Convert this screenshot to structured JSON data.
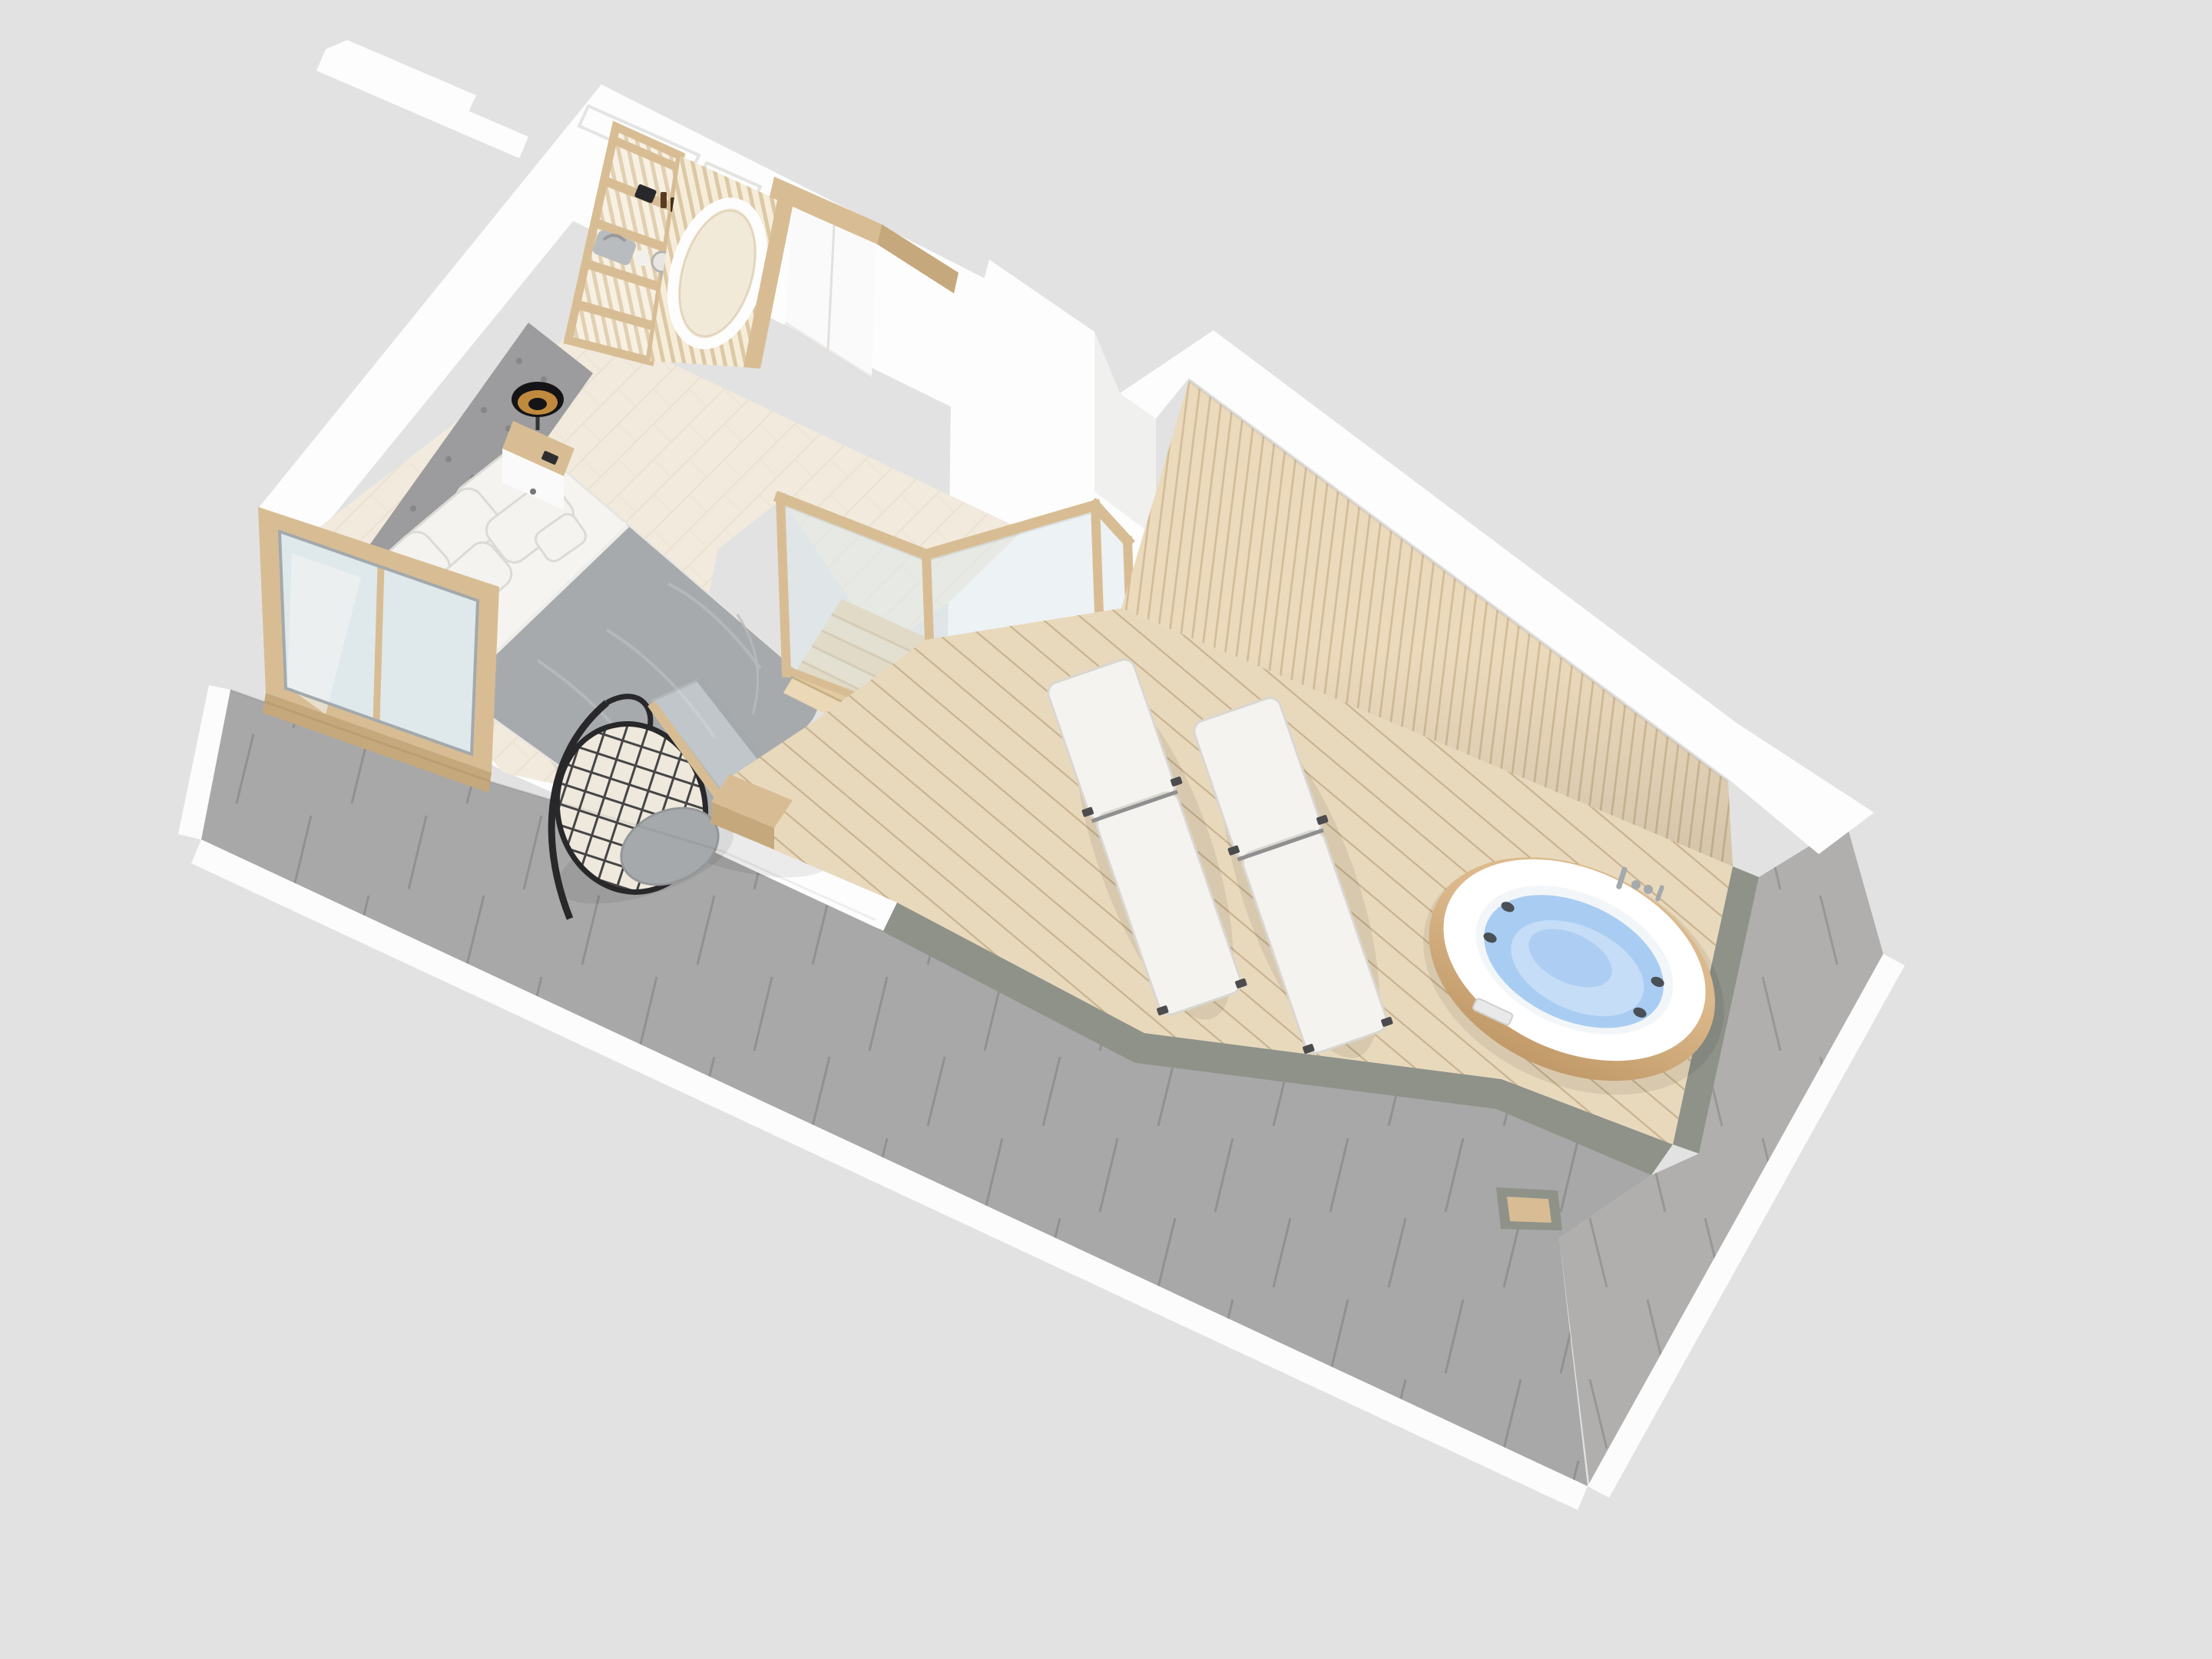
{
  "scene": {
    "kind": "3d-floor-plan-render",
    "view": "isometric top-down",
    "rooms": [
      "attic bedroom",
      "stairwell",
      "roof terrace"
    ]
  },
  "labels": {
    "background": "studio background",
    "roof_left": "tiled roof slope (front)",
    "roof_right": "tiled roof slope (right)",
    "fascia": "white fascia edge",
    "gutter": "roof gutter strip",
    "bedroom_floor": "herringbone parquet floor",
    "outer_walls": "white outer walls",
    "wall_niche_1": "recessed wall niche",
    "wall_niche_2": "recessed wall niche",
    "shelving_unit": "wooden shelving unit with decor",
    "decor_camera": "camera decor object",
    "decor_bottles": "perfume bottles",
    "decor_case": "grey vanity case",
    "decor_jar": "white jar",
    "decor_mirror": "small round table mirror",
    "slat_screen": "wood slat screen with oval cut-out",
    "wardrobe": "white built-in wardrobe",
    "headboard": "upholstered headboard panel",
    "bed": "double bed with grey duvet",
    "pillows": "white pillows",
    "nightstand_right": "wooden nightstand",
    "nightstand_left": "wooden nightstand",
    "lamp_right": "black table lamp",
    "lamp_left": "black table lamp",
    "window": "dormer window",
    "hanging_chair": "rattan hanging egg chair",
    "staircase": "wooden staircase",
    "stair_partition": "white stair partition wall",
    "glass_balustrade": "glass balustrade with oak frame",
    "glass_door": "glass terrace door",
    "terrace_deck": "wooden terrace decking",
    "slat_wall": "vertical slat terrace wall",
    "parapet": "white parapet band",
    "bench": "wooden deck bench",
    "lounger_1": "sun lounger",
    "lounger_2": "sun lounger",
    "hot_tub": "oval hot tub with wooden skirt",
    "tub_faucet": "chrome tub faucet",
    "roof_notch": "roof drainage recess"
  },
  "colors": {
    "background": "#e2e2e2",
    "roof_a": "#a8a8a8",
    "roof_b": "#b0afae",
    "roof_seam": "#7f7f7f",
    "gutter": "#8e9289",
    "fascia": "#fcfcfc",
    "white_wall": "#fdfdfd",
    "wall_shade": "#f0f0ef",
    "niche_edge": "#e4e4e3",
    "floor": "#f1eadd",
    "floor_line": "#d9cbb4",
    "deck": "#e9d9bc",
    "deck_line": "#bfa984",
    "slat_wall": "#ecdabd",
    "slat_line": "#c9b18b",
    "wood": "#d8bd94",
    "wood_dark": "#c5a87c",
    "wood_light": "#e5d2ae",
    "shelf_bg": "#f7f0e3",
    "shelf_slat": "#dcc8a4",
    "screen_bg": "#f5ecd9",
    "oval_fill": "#f2ead8",
    "white_furniture": "#fbfafa",
    "seam": "#e2e0dd",
    "headboard": "#9c9c9e",
    "tuft": "#85858a",
    "sheet": "#f5f4f1",
    "duvet": "#a7aaad",
    "duvet_fold": "#b9bcbf",
    "pillow": "#f4f3f0",
    "pillow_edge": "#dbdad5",
    "lamp_black": "#141416",
    "lamp_gold": "#c08a3e",
    "glass": "#dfe9ec",
    "glass_edge": "#bcc7cb",
    "chrome": "#a3a9ac",
    "chair_black": "#28282b",
    "cushion": "#a6a9ac",
    "stair_wood": "#e2cba2",
    "stair_wood2": "#ead8b6",
    "stair_edge": "#c9b086",
    "lounger": "#f4f3ef",
    "lounger_edge": "#d8d7d1",
    "lounger_frame": "#8f8f8f",
    "tub_wood_1": "#dcb98c",
    "tub_wood_2": "#c29a69",
    "tub_white": "#ffffff",
    "tub_inner": "#f3f6f8",
    "water": "#a9cdf2",
    "water_light": "#c6ddf7",
    "water_deep": "#9cc4ef",
    "jet": "#495056",
    "shadow": "rgba(0,0,0,0.07)"
  }
}
